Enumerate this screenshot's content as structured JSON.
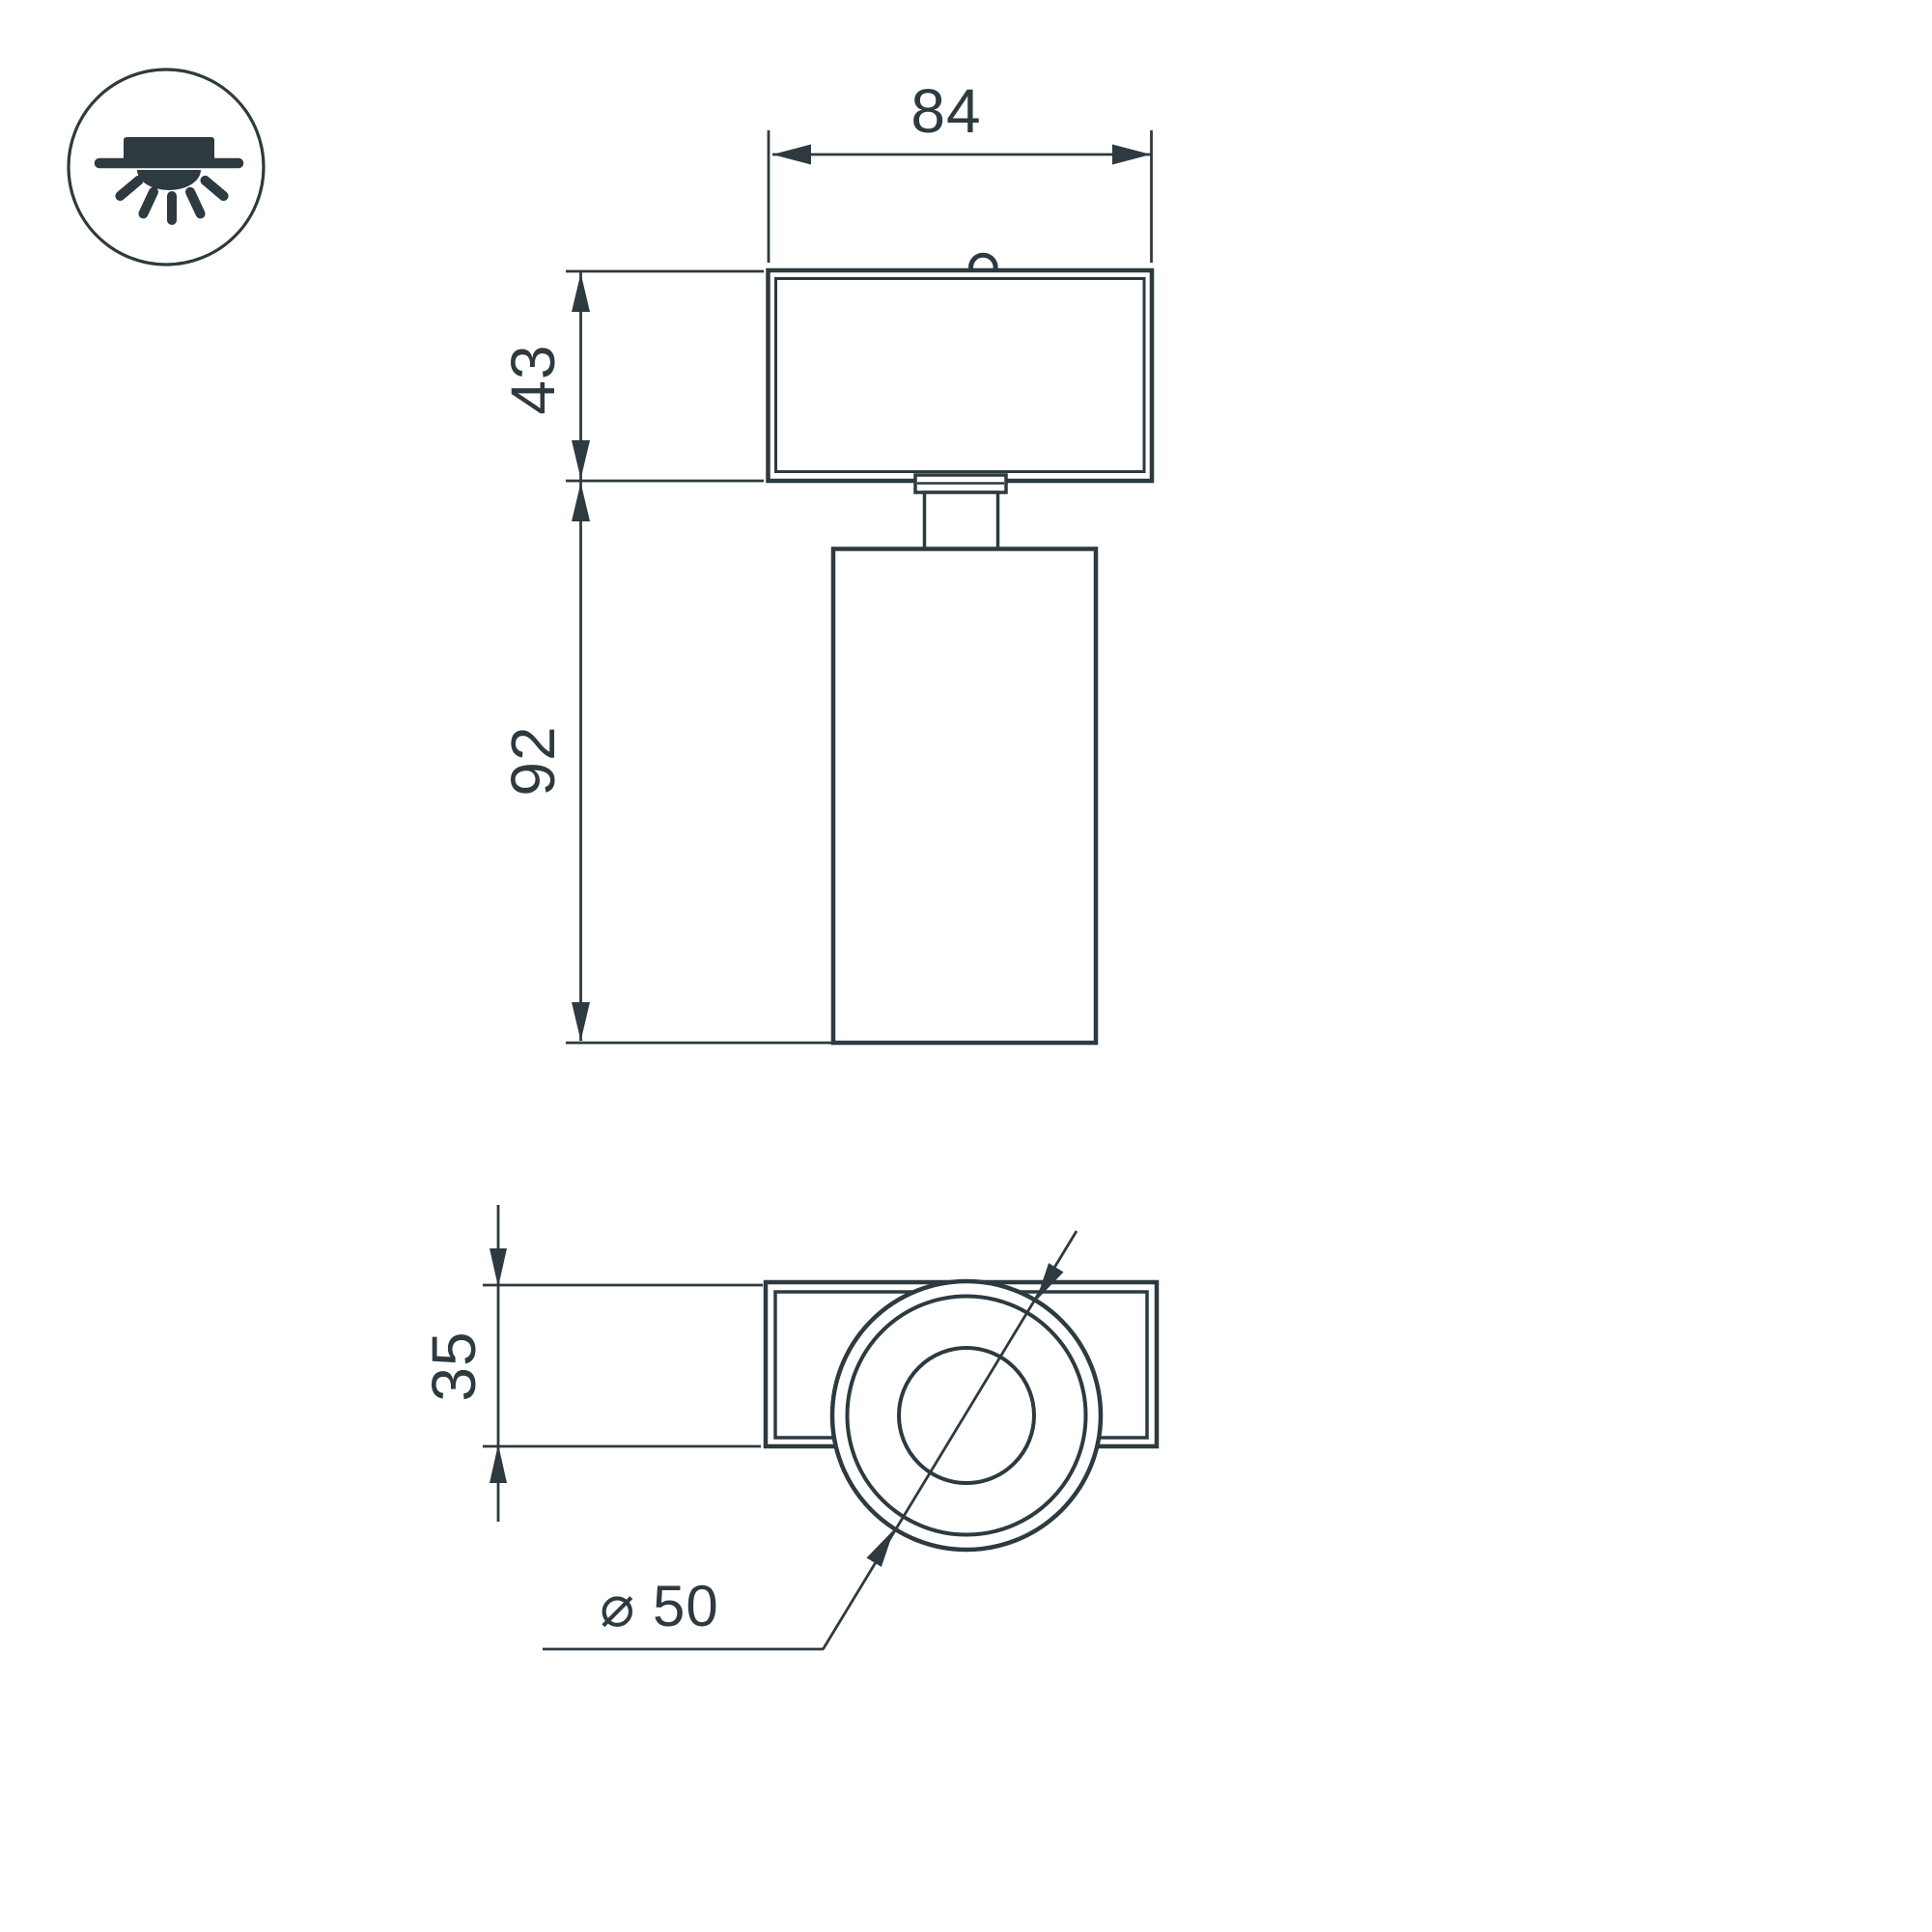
{
  "colors": {
    "ink": "#2d3a40",
    "background": "#ffffff"
  },
  "icon": {
    "name": "surface-mounted-ceiling-light"
  },
  "dimensions": {
    "width_top": "84",
    "mount_height": "43",
    "body_height": "92",
    "bracket_depth": "35",
    "diameter": "⌀ 50"
  }
}
